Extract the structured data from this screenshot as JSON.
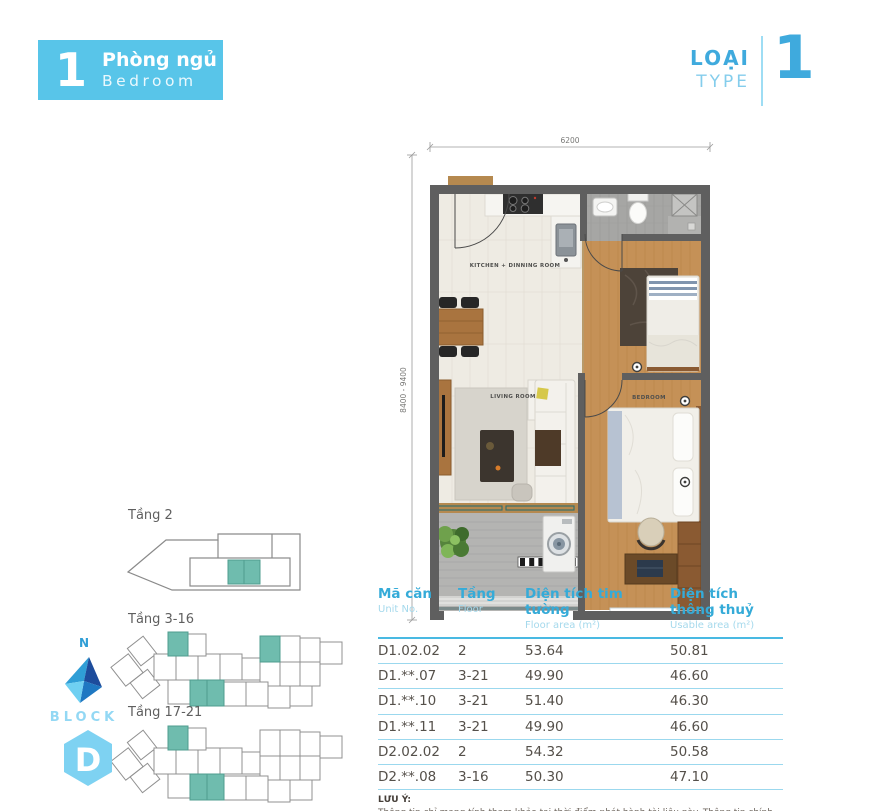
{
  "header": {
    "badge_number": "1",
    "badge_title_vn": "Phòng ngủ",
    "badge_title_en": "Bedroom",
    "type_label_vn": "LOẠI",
    "type_label_en": "TYPE",
    "type_number": "1"
  },
  "floorplan": {
    "dim_width": "6200",
    "dim_height": "8400 - 9400",
    "rooms": {
      "kitchen": "KITCHEN + DINNING ROOM",
      "living": "LIVING ROOM",
      "bedroom": "BEDROOM"
    }
  },
  "block_diagrams": {
    "floor2_label": "Tầng 2",
    "floor3_16_label": "Tầng 3-16",
    "floor17_21_label": "Tầng 17-21",
    "north_label": "N",
    "block_label": "BLOCK",
    "block_name": "D",
    "highlight_color": "#6fbcae"
  },
  "table": {
    "columns": [
      {
        "vn": "Mã căn",
        "en": "Unit No."
      },
      {
        "vn": "Tầng",
        "en": "Floor"
      },
      {
        "vn": "Diện tích tim tường",
        "en": "Floor area (m²)"
      },
      {
        "vn": "Diện tích thông thuỷ",
        "en": "Usable area (m²)"
      }
    ],
    "rows": [
      [
        "D1.02.02",
        "2",
        "53.64",
        "50.81"
      ],
      [
        "D1.**.07",
        "3-21",
        "49.90",
        "46.60"
      ],
      [
        "D1.**.10",
        "3-21",
        "51.40",
        "46.30"
      ],
      [
        "D1.**.11",
        "3-21",
        "49.90",
        "46.60"
      ],
      [
        "D2.02.02",
        "2",
        "54.32",
        "50.58"
      ],
      [
        "D2.**.08",
        "3-16",
        "50.30",
        "47.10"
      ]
    ]
  },
  "note": {
    "title": "LƯU Ý:",
    "body": "Thông tin chỉ mang tính tham khảo tại thời điểm phát hành tài liệu này. Thông tin chính thức căn cứ trên hợp đồng."
  },
  "colors": {
    "accent_blue": "#58c5e9",
    "type_blue": "#3faadd",
    "table_header_blue": "#35abd8",
    "table_sub_blue": "#a5d9ec",
    "highlight_teal": "#6fbcae",
    "wall_gray": "#5f5f5f",
    "wood": "#c59157"
  }
}
